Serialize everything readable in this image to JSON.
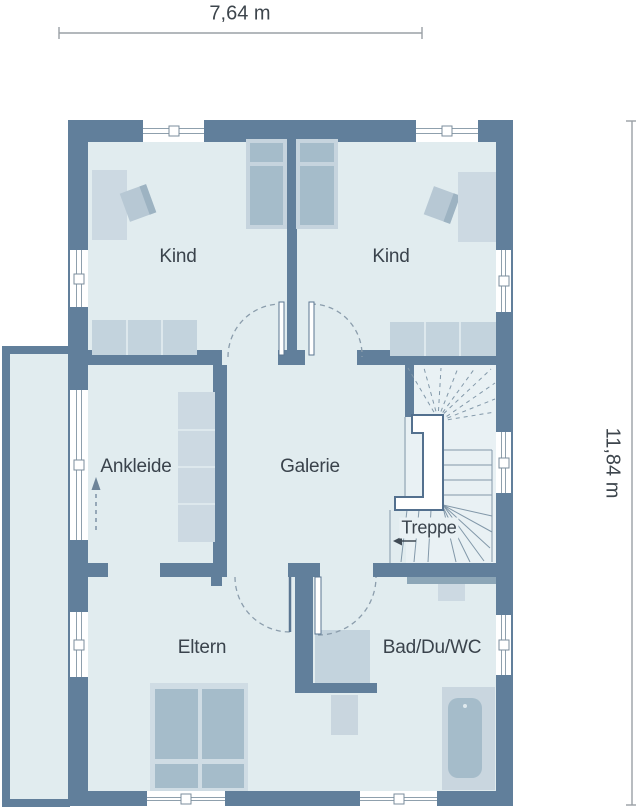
{
  "dimensions": {
    "width": "7,64 m",
    "height": "11,84 m"
  },
  "rooms": {
    "kind_left": "Kind",
    "kind_right": "Kind",
    "ankleide": "Ankleide",
    "galerie": "Galerie",
    "treppe": "Treppe",
    "eltern": "Eltern",
    "bad": "Bad/Du/WC"
  },
  "colors": {
    "wall": "#617f9b",
    "room_fill": "#e1ecef",
    "stair_fill": "#e9f1f4",
    "furniture_light": "#ccd9e2",
    "furniture_medium": "#a5bcca",
    "bed_frame": "#cfdce4",
    "vanity": "#8ca6b7",
    "text": "#3a434c",
    "dimension_line": "#9aa0a5",
    "door_swing_dashed": "#8b9dac"
  }
}
